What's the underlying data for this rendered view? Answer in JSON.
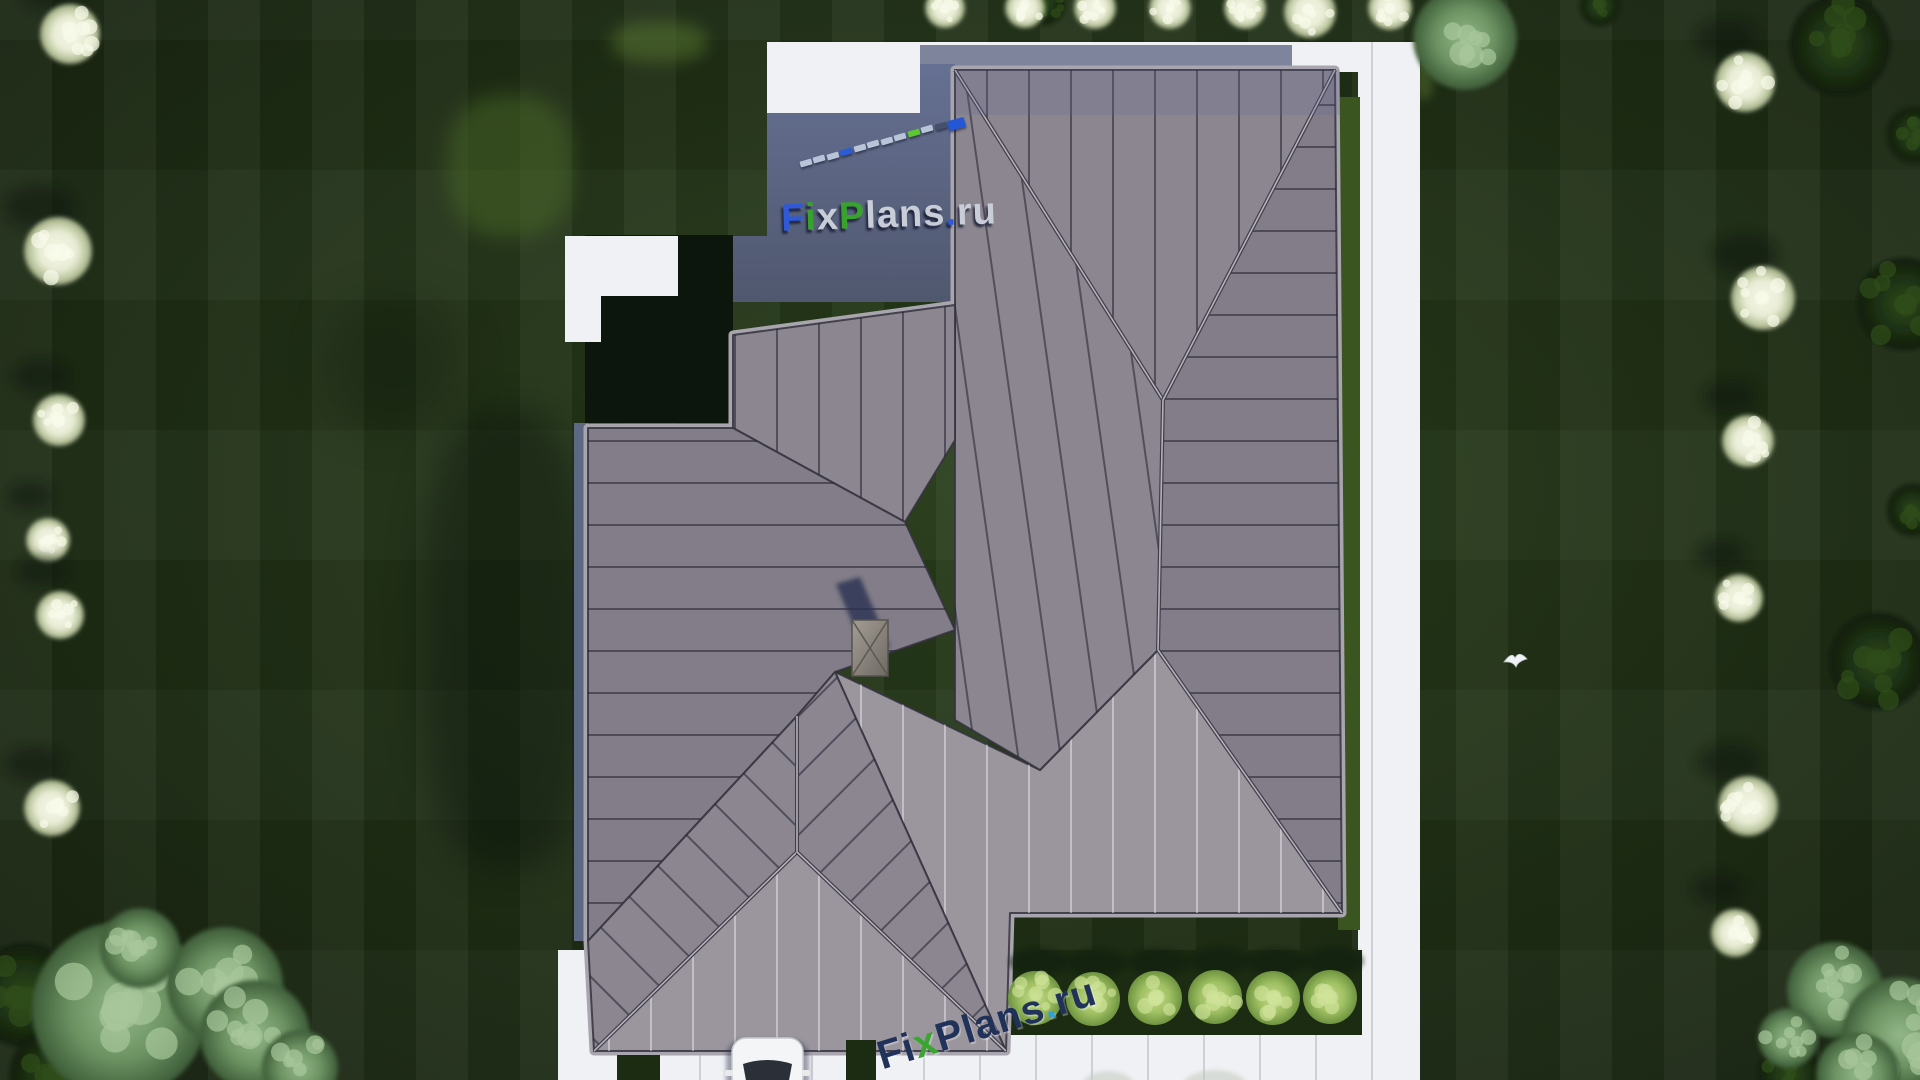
{
  "watermark": {
    "brand_text": "FixPlans.ru",
    "top_logo_pieces": [
      {
        "t": "F",
        "c": "#2e59d9"
      },
      {
        "t": "i",
        "c": "#37a32d"
      },
      {
        "t": "x",
        "c": "#c8cdd8"
      },
      {
        "t": "P",
        "c": "#37a32d"
      },
      {
        "t": "lans",
        "c": "#c8cdd8"
      },
      {
        "t": ".",
        "c": "#2e59d9"
      },
      {
        "t": "ru",
        "c": "#c8cdd8"
      }
    ],
    "bottom_logo_pieces": [
      {
        "t": "F",
        "c": "#21325a"
      },
      {
        "t": "i",
        "c": "#21325a"
      },
      {
        "t": "x",
        "c": "#3aa52f"
      },
      {
        "t": "P",
        "c": "#21325a"
      },
      {
        "t": "lans",
        "c": "#21325a"
      },
      {
        "t": ".",
        "c": "#2e9fd9"
      },
      {
        "t": "ru",
        "c": "#21325a"
      }
    ],
    "dash_line": {
      "x1": 800,
      "y1": 160,
      "x2": 948,
      "y2": 119,
      "count": 12,
      "default_color": "#b9c4d8",
      "accents": {
        "3": "#2b5bd7",
        "8": "#5bc832",
        "10": "#46506b"
      },
      "end_block_color": "#2457d6"
    }
  },
  "colors": {
    "lawn_base": "#243619",
    "path_white": "#f0f1f4",
    "path_shadow_band": "#7d849c",
    "patio_top": "#667092",
    "patio_bottom": "#50586f",
    "courtyard": "#0d160c",
    "fascia_blue": "#5d6983",
    "roof_mid": "#8b8690",
    "roof_dark": "#827d88",
    "roof_light": "#9b969e",
    "roof_outline": "#a9a5ae",
    "seam_dark": "rgba(35,33,48,0.55)",
    "seam_light": "rgba(240,240,245,0.45)",
    "grass_bright": "#3a5520",
    "grass_dark": "#1b2c12",
    "bush_green": "#9fc063",
    "tree_white": "#e9edd6",
    "tree_sage": "#6d9363",
    "tree_dark": "#1c3012",
    "car_body": "#f4f5f6",
    "car_glass": "#2a2f38",
    "chimney": "#8d8780",
    "shadow_navy": "#2b3352",
    "bird_white": "#eef2f4"
  },
  "paths": {
    "top_walk_rect": [
      767,
      42,
      153,
      73
    ],
    "top_strip_rect": [
      920,
      42,
      500,
      30
    ],
    "shade_band_rect": [
      920,
      45,
      372,
      27
    ],
    "right_strip_rect": [
      1358,
      42,
      62,
      1038
    ],
    "driveway_rect": [
      558,
      1035,
      862,
      45
    ],
    "west_stub_rect": [
      558,
      950,
      42,
      130
    ],
    "left_L_rects": [
      [
        565,
        236,
        113,
        60
      ],
      [
        565,
        296,
        36,
        46
      ]
    ],
    "drive_green_strips": [
      [
        617,
        1055,
        43,
        25
      ],
      [
        846,
        1040,
        30,
        40
      ]
    ],
    "slab_line_spacing": 56
  },
  "patio": {
    "points": [
      [
        767,
        113
      ],
      [
        920,
        113
      ],
      [
        920,
        64
      ],
      [
        955,
        64
      ],
      [
        955,
        302
      ],
      [
        733,
        302
      ],
      [
        733,
        236
      ],
      [
        767,
        236
      ]
    ]
  },
  "courtyard": {
    "rect": [
      585,
      235,
      148,
      188
    ]
  },
  "fascia_rect": [
    574,
    423,
    14,
    518
  ],
  "roof": {
    "outline": [
      [
        955,
        70
      ],
      [
        1335,
        70
      ],
      [
        1342,
        913
      ],
      [
        1010,
        913
      ],
      [
        1006,
        1051
      ],
      [
        594,
        1051
      ],
      [
        588,
        941
      ],
      [
        588,
        428
      ],
      [
        733,
        428
      ],
      [
        733,
        335
      ],
      [
        955,
        305
      ]
    ],
    "planes": [
      {
        "name": "east-plane",
        "points": [
          [
            1335,
            70
          ],
          [
            1163,
            400
          ],
          [
            1158,
            650
          ],
          [
            1342,
            913
          ]
        ],
        "tone": "dark",
        "seams": "h"
      },
      {
        "name": "north-plane",
        "points": [
          [
            955,
            70
          ],
          [
            1335,
            70
          ],
          [
            1163,
            400
          ]
        ],
        "tone": "mid",
        "seams": "v"
      },
      {
        "name": "south-plane",
        "points": [
          [
            1158,
            650
          ],
          [
            1342,
            913
          ],
          [
            1010,
            913
          ],
          [
            1006,
            1051
          ],
          [
            835,
            672
          ],
          [
            1040,
            770
          ]
        ],
        "tone": "light",
        "seams": "vl"
      },
      {
        "name": "center-plane",
        "points": [
          [
            955,
            70
          ],
          [
            1163,
            400
          ],
          [
            1158,
            650
          ],
          [
            1040,
            770
          ],
          [
            955,
            720
          ]
        ],
        "tone": "mid",
        "seams": "vt"
      },
      {
        "name": "wing-north-slope",
        "points": [
          [
            733,
            335
          ],
          [
            955,
            305
          ],
          [
            955,
            440
          ],
          [
            905,
            522
          ],
          [
            733,
            428
          ]
        ],
        "tone": "mid",
        "seams": "v"
      },
      {
        "name": "west-plane",
        "points": [
          [
            588,
            428
          ],
          [
            733,
            428
          ],
          [
            905,
            522
          ],
          [
            955,
            630
          ],
          [
            835,
            672
          ],
          [
            797,
            716
          ],
          [
            588,
            941
          ]
        ],
        "tone": "dark",
        "seams": "h"
      },
      {
        "name": "garage-west-slope",
        "points": [
          [
            797,
            716
          ],
          [
            797,
            852
          ],
          [
            594,
            1051
          ],
          [
            588,
            941
          ]
        ],
        "tone": "mid",
        "seams": "d2"
      },
      {
        "name": "garage-south-slope",
        "points": [
          [
            797,
            852
          ],
          [
            1006,
            1051
          ],
          [
            594,
            1051
          ]
        ],
        "tone": "light",
        "seams": "vl"
      },
      {
        "name": "garage-east-slope",
        "points": [
          [
            797,
            716
          ],
          [
            835,
            672
          ],
          [
            1006,
            1051
          ],
          [
            797,
            852
          ]
        ],
        "tone": "mid",
        "seams": "d1"
      }
    ],
    "ridge_lines": [
      [
        [
          955,
          70
        ],
        [
          1163,
          400
        ]
      ],
      [
        [
          1335,
          70
        ],
        [
          1163,
          400
        ]
      ],
      [
        [
          1163,
          400
        ],
        [
          1158,
          650
        ]
      ],
      [
        [
          797,
          716
        ],
        [
          797,
          852
        ]
      ],
      [
        [
          797,
          852
        ],
        [
          594,
          1051
        ]
      ],
      [
        [
          797,
          852
        ],
        [
          1006,
          1051
        ]
      ],
      [
        [
          1158,
          650
        ],
        [
          1342,
          913
        ]
      ]
    ],
    "north_shade_rect": [
      955,
      70,
      385,
      45
    ]
  },
  "chimney": {
    "rect": [
      852,
      620,
      36,
      56
    ],
    "shadow_points": [
      [
        836,
        584
      ],
      [
        860,
        577
      ],
      [
        890,
        647
      ],
      [
        866,
        656
      ]
    ]
  },
  "garden": {
    "east_grass_strip": [
      1338,
      97,
      22,
      833
    ],
    "bush_strip": [
      1008,
      950,
      354,
      85
    ],
    "bushes": [
      [
        1035,
        998
      ],
      [
        1093,
        999
      ],
      [
        1155,
        998
      ],
      [
        1215,
        997
      ],
      [
        1273,
        998
      ],
      [
        1330,
        997
      ]
    ],
    "bush_radius": 27
  },
  "trees": {
    "white": [
      [
        70,
        34,
        30
      ],
      [
        58,
        251,
        34
      ],
      [
        59,
        420,
        26
      ],
      [
        48,
        540,
        22
      ],
      [
        60,
        615,
        24
      ],
      [
        52,
        808,
        28
      ],
      [
        945,
        8,
        20
      ],
      [
        1025,
        8,
        20
      ],
      [
        1095,
        8,
        21
      ],
      [
        1170,
        8,
        21
      ],
      [
        1245,
        8,
        21
      ],
      [
        1310,
        12,
        26
      ],
      [
        1390,
        8,
        22
      ],
      [
        1745,
        82,
        30
      ],
      [
        1763,
        298,
        32
      ],
      [
        1748,
        441,
        26
      ],
      [
        1739,
        598,
        24
      ],
      [
        1748,
        806,
        30
      ],
      [
        1735,
        933,
        24
      ]
    ],
    "sage": [
      [
        1465,
        38,
        52
      ],
      [
        120,
        1010,
        88
      ],
      [
        225,
        985,
        58
      ],
      [
        255,
        1035,
        55
      ],
      [
        140,
        948,
        40
      ],
      [
        300,
        1068,
        38
      ],
      [
        1835,
        990,
        48
      ],
      [
        1900,
        1035,
        58
      ],
      [
        1858,
        1075,
        42
      ],
      [
        1788,
        1038,
        30
      ]
    ],
    "dark": [
      [
        1840,
        45,
        50
      ],
      [
        1915,
        135,
        28
      ],
      [
        1904,
        304,
        46
      ],
      [
        1913,
        510,
        26
      ],
      [
        1878,
        661,
        48
      ],
      [
        25,
        995,
        52
      ],
      [
        55,
        1075,
        45
      ],
      [
        1790,
        1075,
        32
      ],
      [
        1600,
        6,
        20
      ],
      [
        1043,
        3,
        22
      ],
      [
        1457,
        16,
        28
      ]
    ],
    "edge_tops": [
      [
        1108,
        1085,
        26,
        14
      ],
      [
        1215,
        1086,
        32,
        16
      ]
    ]
  },
  "lawn_patches": [
    {
      "x": 420,
      "y": 410,
      "w": 175,
      "h": 460,
      "color": "#0a130a",
      "op": 0.45,
      "blur": 18
    },
    {
      "x": 448,
      "y": 95,
      "w": 125,
      "h": 142,
      "color": "#4a6a28",
      "op": 0.5,
      "blur": 10
    },
    {
      "x": 612,
      "y": 22,
      "w": 95,
      "h": 40,
      "color": "#55732e",
      "op": 0.55,
      "blur": 8
    },
    {
      "x": 1415,
      "y": 58,
      "w": 18,
      "h": 42,
      "color": "#55732e",
      "op": 0.5,
      "blur": 5
    },
    {
      "x": 330,
      "y": 300,
      "w": 130,
      "h": 130,
      "color": "#0a130a",
      "op": 0.25,
      "blur": 22
    },
    {
      "x": 1040,
      "y": 760,
      "w": 60,
      "h": 60,
      "color": "#101720",
      "op": 0.0,
      "blur": 10
    }
  ],
  "car": {
    "x": 732,
    "y": 1038,
    "w": 71,
    "h": 60
  },
  "bird": {
    "x": 1515,
    "y": 658
  }
}
